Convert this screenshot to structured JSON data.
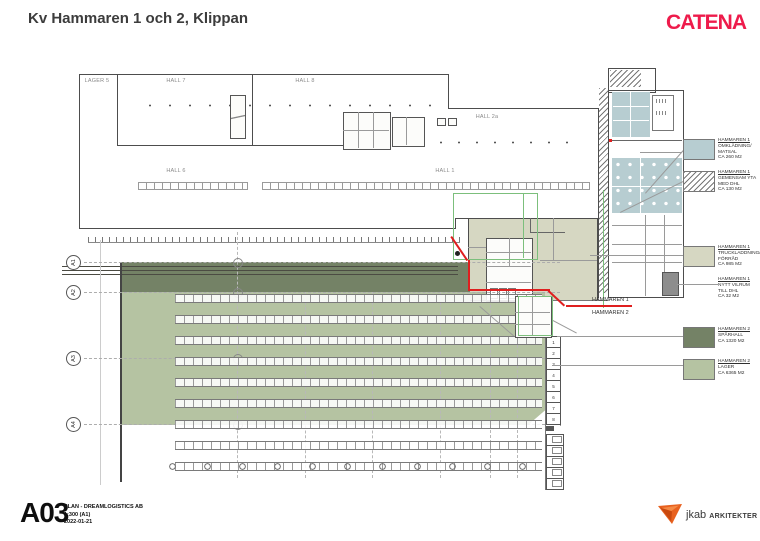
{
  "header": {
    "title": "Kv Hammaren 1 och 2, Klippan",
    "brand": "CATENA"
  },
  "plan": {
    "halls": [
      "LAGER 5",
      "HALL 7",
      "HALL 8",
      "HALL 2a",
      "HALL 6",
      "HALL 1"
    ],
    "grid": [
      "A1",
      "A2",
      "A3",
      "A4"
    ],
    "boundary_labels": [
      "HAMMAREN 1",
      "HAMMAREN 2"
    ],
    "dock_numbers": [
      "1",
      "2",
      "3",
      "4",
      "5",
      "6",
      "7",
      "8"
    ]
  },
  "legend": {
    "items": [
      {
        "title": "HAMMAREN 1",
        "l2": "OMKLÄDNING/",
        "l3": "MATSAL",
        "area": "CA 260 M2",
        "swatch": "blue"
      },
      {
        "title": "HAMMAREN 1",
        "l2": "GEMENSAM YTA",
        "l3": "MED DHL",
        "area": "CA 130 M2",
        "swatch": "hatch"
      },
      {
        "title": "HAMMAREN 1",
        "l2": "TRUCKLADDNING/",
        "l3": "FÖRRÅD",
        "area": "CA 985 M2",
        "swatch": "beige"
      },
      {
        "title": "HAMMAREN 1",
        "l2": "NYTT VILRUM",
        "l3": "TILL DHL",
        "area": "CA 32 M2",
        "swatch": "gray-room"
      },
      {
        "title": "HAMMAREN 2",
        "l2": "SPÅRHALL",
        "l3": "",
        "area": "CA 1320 M2",
        "swatch": "dark-green"
      },
      {
        "title": "HAMMAREN 2",
        "l2": "LAGER",
        "l3": "",
        "area": "CA 6365 M2",
        "swatch": "light-green"
      }
    ]
  },
  "titleblock": {
    "sheet": "A03",
    "line1": "PLAN - DREAMLOGISTICS AB",
    "line2": "1:300 (A1)",
    "line3": "2022-01-21"
  },
  "footer_brand": {
    "name": "jkab",
    "suffix": "ARKITEKTER"
  },
  "colors": {
    "catena_red": "#ee1b4b",
    "boundary_red": "#df1f1f",
    "hammaren1_blue": "#b7cdd1",
    "hammaren1_beige": "#d6d7c2",
    "hammaren2_dark_green": "#748266",
    "hammaren2_light_green": "#b5c3a2",
    "vilrum_gray": "#8d8d8d",
    "jkab_orange": "#e8611f"
  }
}
